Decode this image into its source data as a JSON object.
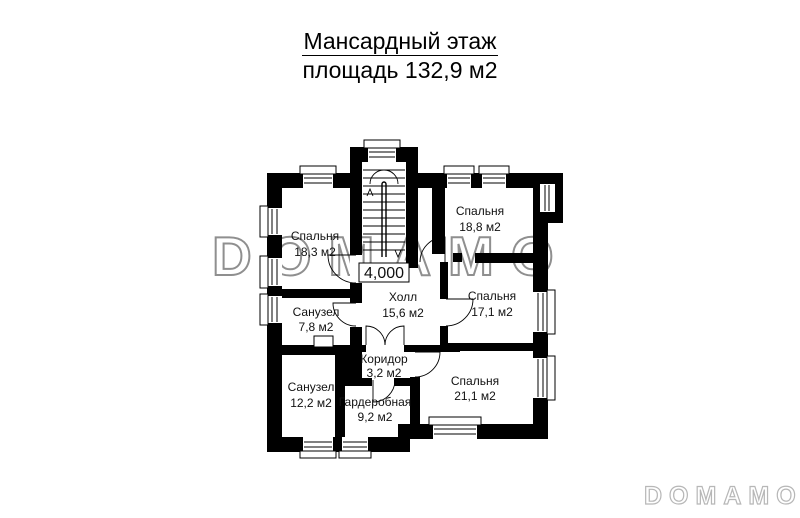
{
  "title": {
    "line1": "Мансардный этаж",
    "line2": "площадь 132,9 м2"
  },
  "plan": {
    "elevation": "4,000",
    "rooms": [
      {
        "name": "Спальня",
        "area": "18,3 м2"
      },
      {
        "name": "Спальня",
        "area": "18,8 м2"
      },
      {
        "name": "Санузел",
        "area": "7,8 м2"
      },
      {
        "name": "Холл",
        "area": "15,6 м2"
      },
      {
        "name": "Спальня",
        "area": "17,1 м2"
      },
      {
        "name": "Коридор",
        "area": "3,2 м2"
      },
      {
        "name": "Санузел",
        "area": "12,2 м2"
      },
      {
        "name": "Гардеробная",
        "area": "9,2 м2"
      },
      {
        "name": "Спальня",
        "area": "21,1 м2"
      }
    ]
  },
  "watermark": {
    "center": "DOMAMO",
    "corner": "DOMAMO"
  },
  "colors": {
    "wall": "#000000",
    "background": "#ffffff",
    "watermark_center_outline": "#8f8f8f",
    "watermark_corner_outline": "#b7b7b7",
    "text": "#111111"
  }
}
